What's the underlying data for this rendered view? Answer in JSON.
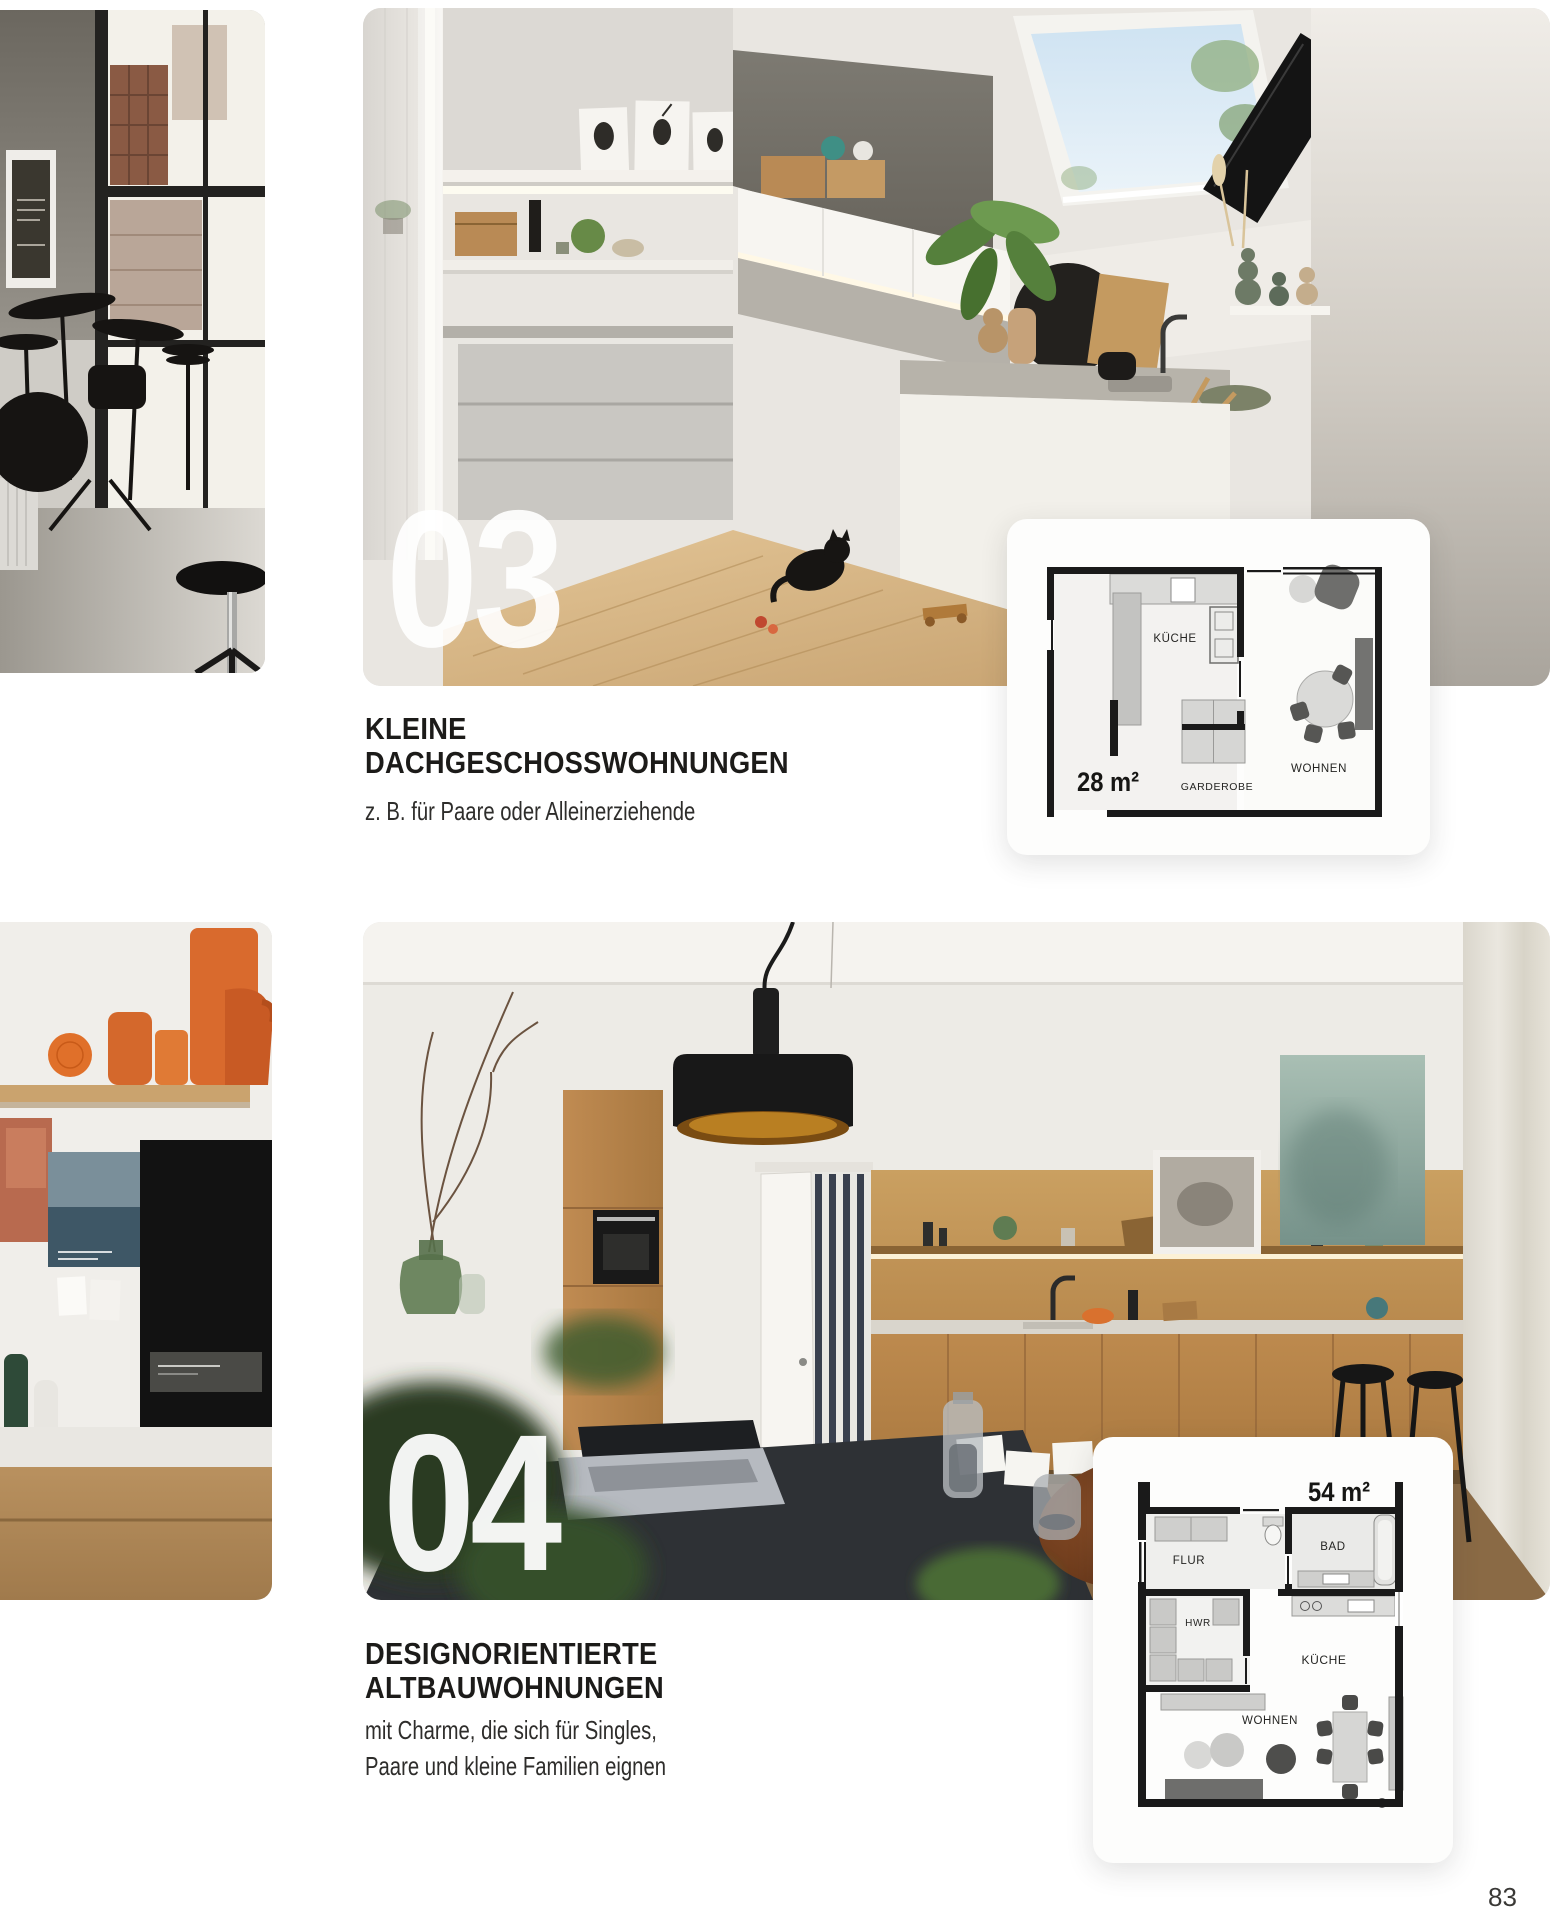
{
  "print_mark": {
    "colors": [
      "#56b8e6",
      "#cf6ab0",
      "#f2e93e",
      "#161616"
    ]
  },
  "section_03": {
    "number": "03",
    "title_line1": "KLEINE",
    "title_line2": "DACHGESCHOSSWOHNUNGEN",
    "subtitle": "z. B. für Paare oder Alleinerziehende",
    "floorplan": {
      "area_label": "28 m²",
      "rooms": [
        "KÜCHE",
        "WOHNEN",
        "GARDEROBE"
      ]
    }
  },
  "section_04": {
    "number": "04",
    "title_line1": "DESIGNORIENTIERTE",
    "title_line2": "ALTBAUWOHNUNGEN",
    "subtitle_line1": "mit Charme, die sich für Singles,",
    "subtitle_line2": "Paare und kleine Familien eignen",
    "floorplan": {
      "area_label": "54 m²",
      "rooms": [
        "FLUR",
        "BAD",
        "HWR",
        "KÜCHE",
        "WOHNEN"
      ]
    }
  },
  "page": {
    "number": "83"
  }
}
